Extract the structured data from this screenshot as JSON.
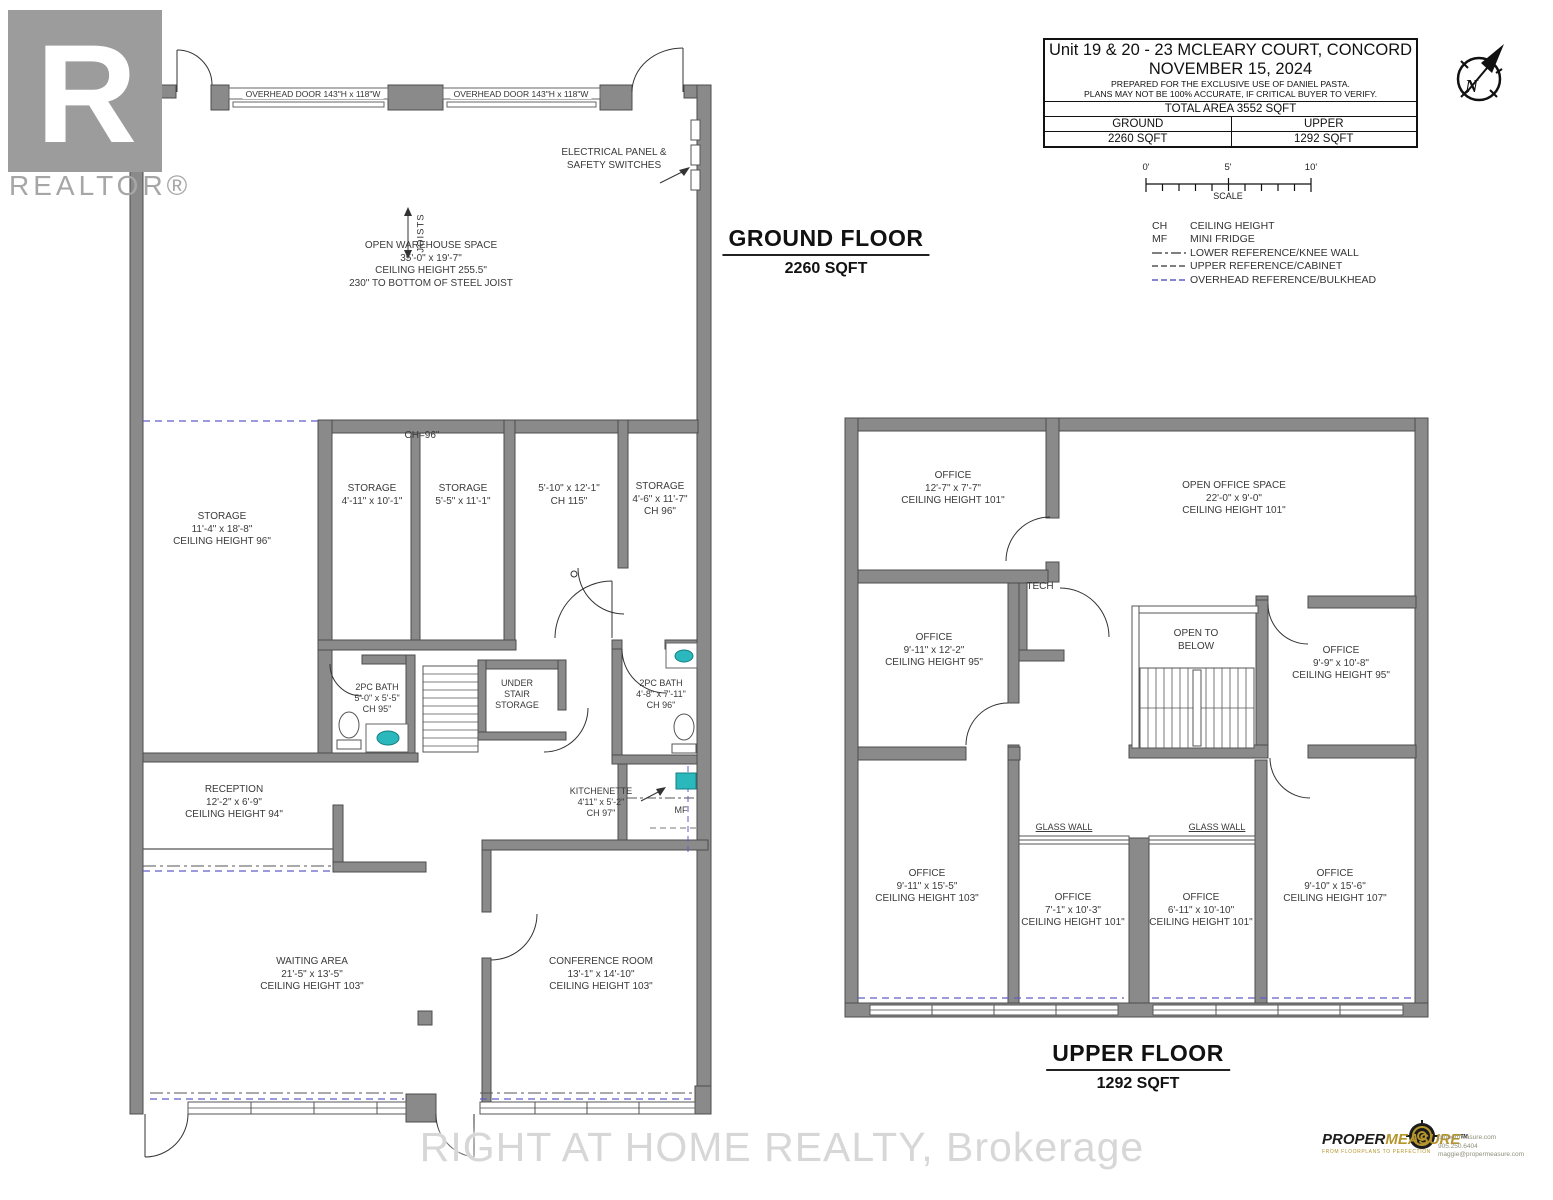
{
  "branding": {
    "realtor_letter": "R",
    "realtor_text": "REALTOR®",
    "watermark": "RIGHT AT HOME REALTY, Brokerage"
  },
  "title_block": {
    "address": "Unit 19 & 20 - 23 MCLEARY COURT, CONCORD",
    "date": "NOVEMBER 15, 2024",
    "prepared": "PREPARED FOR THE EXCLUSIVE USE OF DANIEL PASTA.",
    "disclaimer": "PLANS MAY NOT BE 100% ACCURATE, IF CRITICAL BUYER TO VERIFY.",
    "total": "TOTAL AREA 3552 SQFT",
    "ground_header": "GROUND",
    "upper_header": "UPPER",
    "ground_sqft": "2260 SQFT",
    "upper_sqft": "1292 SQFT"
  },
  "scale_bar": {
    "zero": "0'",
    "five": "5'",
    "ten": "10'",
    "label": "SCALE"
  },
  "compass": {
    "n": "N"
  },
  "legend": {
    "ch_abbr": "CH",
    "ch": "CEILING HEIGHT",
    "mf_abbr": "MF",
    "mf": "MINI FRIDGE",
    "knee": "LOWER REFERENCE/KNEE WALL",
    "cabinet": "UPPER REFERENCE/CABINET",
    "bulkhead": "OVERHEAD REFERENCE/BULKHEAD"
  },
  "ground": {
    "heading": "GROUND FLOOR",
    "sqft": "2260 SQFT",
    "overhead_door_1": "OVERHEAD DOOR 143\"H x 118\"W",
    "overhead_door_2": "OVERHEAD DOOR 143\"H x 118\"W",
    "electrical_1": "ELECTRICAL PANEL &",
    "electrical_2": "SAFETY SWITCHES",
    "joists": "JOISTS",
    "warehouse": {
      "l1": "OPEN WAREHOUSE SPACE",
      "l2": "35'-0\" x 19'-7\"",
      "l3": "CEILING HEIGHT 255.5\"",
      "l4": "230\" TO BOTTOM OF STEEL JOIST"
    },
    "ch96": "CH=96\"",
    "storage_big": {
      "l1": "STORAGE",
      "l2": "11'-4\" x 18'-8\"",
      "l3": "CEILING HEIGHT 96\""
    },
    "storage_a": {
      "l1": "STORAGE",
      "l2": "4'-11\" x 10'-1\""
    },
    "storage_b": {
      "l1": "STORAGE",
      "l2": "5'-5\" x 11'-1\""
    },
    "hall": {
      "l1": "5'-10\" x 12'-1\"",
      "l2": "CH 115\""
    },
    "storage_c": {
      "l1": "STORAGE",
      "l2": "4'-6\" x 11'-7\"",
      "l3": "CH 96\""
    },
    "bath1": {
      "l1": "2PC BATH",
      "l2": "5'-0\" x 5'-5\"",
      "l3": "CH 95\""
    },
    "understair": {
      "l1": "UNDER",
      "l2": "STAIR",
      "l3": "STORAGE"
    },
    "bath2": {
      "l1": "2PC BATH",
      "l2": "4'-8\" x 7'-11\"",
      "l3": "CH 96\""
    },
    "kitchenette": {
      "l1": "KITCHENETTE",
      "l2": "4'11\" x 5'-2\"",
      "l3": "CH 97\""
    },
    "mf": "MF",
    "reception": {
      "l1": "RECEPTION",
      "l2": "12'-2\" x 6'-9\"",
      "l3": "CEILING HEIGHT 94\""
    },
    "waiting": {
      "l1": "WAITING AREA",
      "l2": "21'-5\" x 13'-5\"",
      "l3": "CEILING HEIGHT 103\""
    },
    "conference": {
      "l1": "CONFERENCE ROOM",
      "l2": "13'-1\" x 14'-10\"",
      "l3": "CEILING HEIGHT 103\""
    }
  },
  "upper": {
    "heading": "UPPER FLOOR",
    "sqft": "1292 SQFT",
    "office_a": {
      "l1": "OFFICE",
      "l2": "12'-7\" x 7'-7\"",
      "l3": "CEILING HEIGHT 101\""
    },
    "open_office": {
      "l1": "OPEN OFFICE SPACE",
      "l2": "22'-0\" x 9'-0\"",
      "l3": "CEILING HEIGHT 101\""
    },
    "tech": "TECH",
    "office_b": {
      "l1": "OFFICE",
      "l2": "9'-11\" x 12'-2\"",
      "l3": "CEILING HEIGHT 95\""
    },
    "open_below": {
      "l1": "OPEN TO",
      "l2": "BELOW"
    },
    "office_c": {
      "l1": "OFFICE",
      "l2": "9'-9\" x 10'-8\"",
      "l3": "CEILING HEIGHT 95\""
    },
    "office_d": {
      "l1": "OFFICE",
      "l2": "9'-11\" x 15'-5\"",
      "l3": "CEILING HEIGHT 103\""
    },
    "glass_wall_1": "GLASS WALL",
    "glass_wall_2": "GLASS WALL",
    "office_e": {
      "l1": "OFFICE",
      "l2": "7'-1\" x 10'-3\"",
      "l3": "CEILING HEIGHT 101\""
    },
    "office_f": {
      "l1": "OFFICE",
      "l2": "6'-11\" x 10'-10\"",
      "l3": "CEILING HEIGHT 101\""
    },
    "office_g": {
      "l1": "OFFICE",
      "l2": "9'-10\" x 15'-6\"",
      "l3": "CEILING HEIGHT 107\""
    }
  },
  "footer": {
    "pm_brand_1": "PROPER",
    "pm_brand_2": "MEASURE",
    "pm_tm": "TM",
    "pm_tagline": "FROM FLOORPLANS TO PERFECTION",
    "pm_web": "propermeasure.com",
    "pm_phone": "905.250.6404",
    "pm_email": "maggie@propermeasure.com"
  },
  "colors": {
    "wall": "#8a8a8a",
    "fixture_teal": "#2ab8bc",
    "overhead_blue": "#5d5dc8"
  }
}
